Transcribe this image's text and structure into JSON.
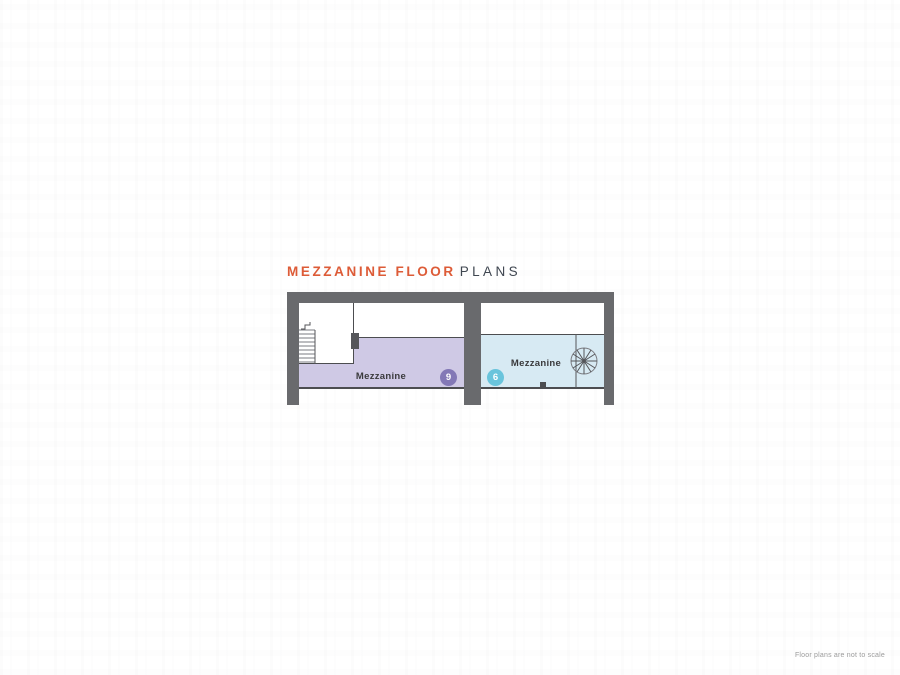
{
  "header": {
    "title_primary": "MEZZANINE FLOOR",
    "title_secondary": "PLANS"
  },
  "floor_plan": {
    "units": [
      {
        "position": "left",
        "room_label": "Mezzanine",
        "badge": "9",
        "fill_color": "#CFC9E5",
        "badge_color": "#8378B6",
        "feature": "straight-staircase-with-void"
      },
      {
        "position": "right",
        "room_label": "Mezzanine",
        "badge": "6",
        "fill_color": "#D7EAF3",
        "badge_color": "#69C4DC",
        "feature": "spiral-staircase"
      }
    ],
    "wall_color": "#696A6D",
    "outline_color": "#4C4D50"
  },
  "footer": {
    "disclaimer": "Floor plans are not to scale"
  },
  "colors": {
    "accent_orange": "#DD5B37",
    "title_gray": "#3F4650",
    "footnote_gray": "#9B9B9B",
    "background": "#FFFFFF"
  }
}
